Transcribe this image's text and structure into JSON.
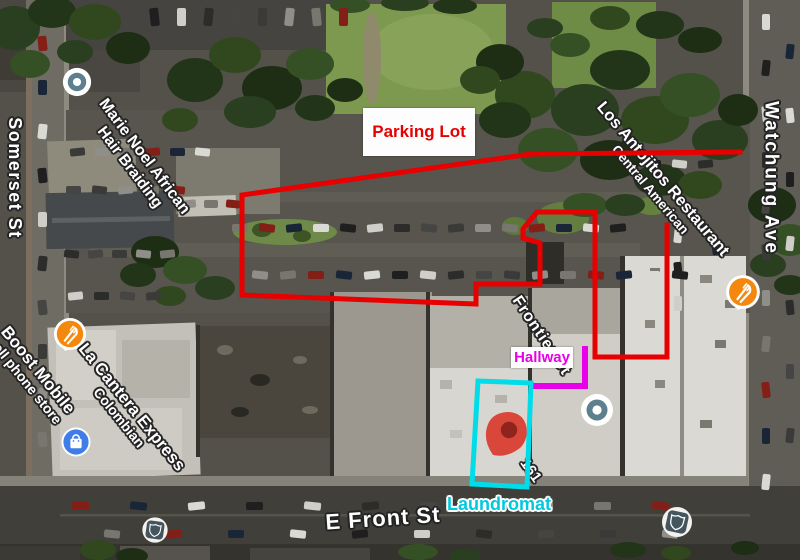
{
  "streets": {
    "somerset": "Somerset St",
    "watchung": "Watchung Ave",
    "efront": "E Front St",
    "frontier": "Frontier St",
    "address": "161"
  },
  "places": {
    "marie_noel": {
      "line1": "Marie Noel African",
      "line2": "Hair Braiding"
    },
    "los_antojitos": {
      "line1": "Los Antojitos Restaurant",
      "line2": "Central American"
    },
    "boost_mobile": {
      "line1": "Boost Mobile",
      "line2": "cell phone store"
    },
    "la_cantera": {
      "line1": "La Cantera Express",
      "line2": "Colombian"
    }
  },
  "annotations": {
    "parking_lot": {
      "label": "Parking Lot",
      "color": "#e80000"
    },
    "hallway": {
      "label": "Hallway",
      "color": "#e800e8"
    },
    "laundromat": {
      "label": "Laundromat",
      "color": "#00dce8"
    },
    "pin": {
      "body_color": "#d9473b",
      "dot_color": "#8e241b"
    }
  },
  "icons": {
    "generic_poi": "poi-dot-icon",
    "restaurant": "restaurant-icon",
    "shopping": "shopping-bag-icon",
    "route_shield": "route-shield-icon",
    "map_pin": "map-pin-icon"
  },
  "poi_colors": {
    "restaurant_orange": "#f4880e",
    "shopping_blue": "#3f7ee8",
    "generic_slate": "#5d7f8e",
    "shield_slate": "#44555e"
  }
}
